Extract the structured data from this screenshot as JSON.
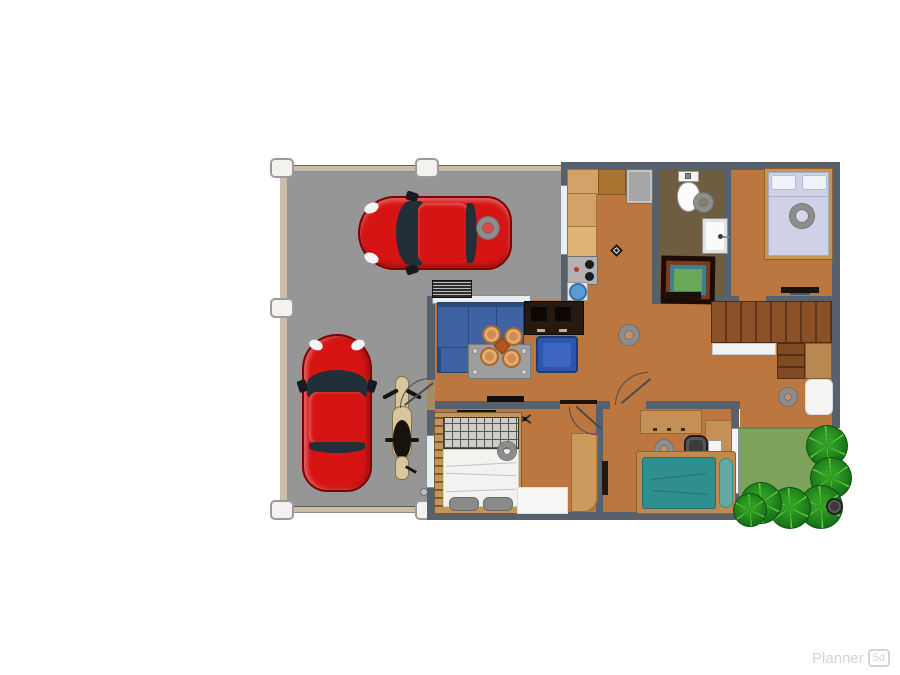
{
  "watermark": {
    "brand": "Planner",
    "badge": "5d"
  },
  "scene": {
    "type": "2d-floor-plan-top-view",
    "palette": {
      "garage_floor": "#969696",
      "interior_floor": "#bc7640",
      "bathroom_floor": "#6e5d3f",
      "wall": "#57606d",
      "lawn": "#7da25c",
      "bush": "#187119",
      "car_red": "#d61414",
      "sofa_blue": "#3e62a2",
      "armchair_blue": "#2d56ae",
      "bed_teal": "#2f8f8f",
      "bedding_lavender": "#cfd2e6",
      "counter_tan": "#d2a268",
      "stair_wood": "#8a5129"
    },
    "rooms": [
      {
        "name": "garage",
        "floor": "gray concrete",
        "contents": [
          "red car horizontal",
          "red car vertical",
          "motorcycle",
          "wall vent",
          "door handle"
        ]
      },
      {
        "name": "kitchen",
        "floor": "terracotta",
        "contents": [
          "L-shaped counter",
          "fridge",
          "stove with two burners",
          "round blue sink",
          "diamond marker"
        ]
      },
      {
        "name": "bathroom",
        "floor": "dark olive",
        "contents": [
          "toilet",
          "washbasin with faucet",
          "ceiling light"
        ]
      },
      {
        "name": "main-bedroom",
        "floor": "terracotta",
        "contents": [
          "double bed with two pillows",
          "wall tv"
        ]
      },
      {
        "name": "living-dining-hall",
        "floor": "terracotta",
        "contents": [
          "corner sofa",
          "tv cabinet",
          "blue armchair",
          "dining table with four chairs",
          "framed green table",
          "l-shaped wooden stairs",
          "white landing",
          "white rug",
          "wall tv bars"
        ]
      },
      {
        "name": "bedroom-2",
        "floor": "terracotta",
        "contents": [
          "double bed with grid headboard and two gray pillows",
          "white rug",
          "wardrobe",
          "wall shelf",
          "ceiling fan icon"
        ]
      },
      {
        "name": "bedroom-3",
        "floor": "terracotta",
        "contents": [
          "single teal bed with pillow",
          "desk",
          "office chair",
          "side desk with laptop",
          "wall shelf"
        ]
      },
      {
        "name": "garden",
        "floor": "lawn",
        "contents": [
          "lawn patch",
          "six round bushes",
          "plant pot"
        ]
      }
    ],
    "markers": {
      "ceiling_lights": 7,
      "white_pillars": 5,
      "doors": 5,
      "windows": 3
    }
  }
}
